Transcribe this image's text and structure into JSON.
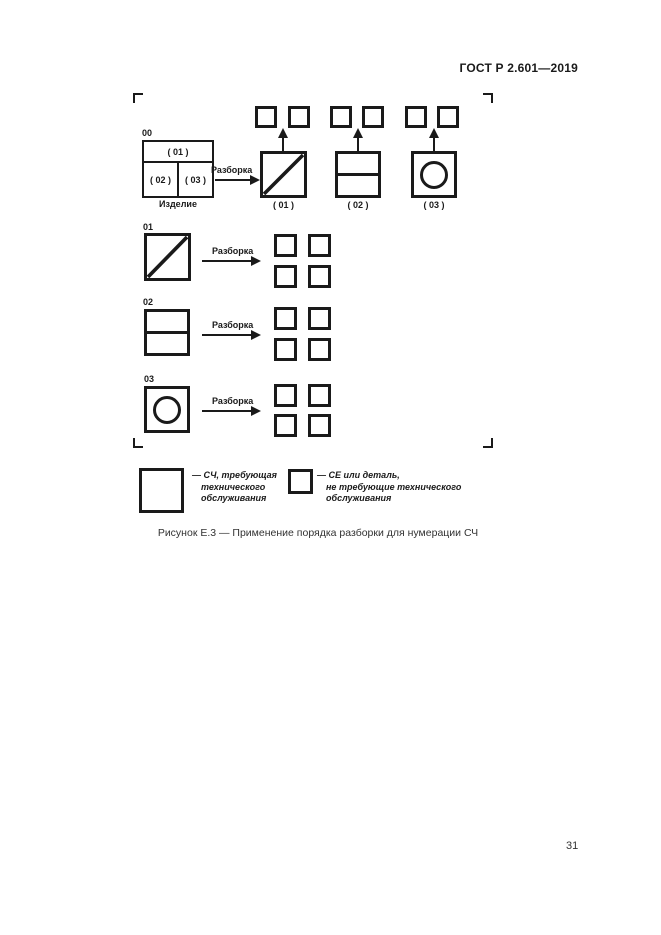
{
  "header": {
    "title": "ГОСТ Р 2.601—2019"
  },
  "footer": {
    "page_number": "31"
  },
  "figure": {
    "caption": "Рисунок Е.3 — Применение порядка разборки для нумерации СЧ",
    "arrow_label": "Разборка",
    "product": {
      "id": "00",
      "cell_top": "( 01 )",
      "cell_left": "( 02 )",
      "cell_right": "( 03 )",
      "caption": "Изделие"
    },
    "level1": [
      {
        "label": "( 01 )"
      },
      {
        "label": "( 02 )"
      },
      {
        "label": "( 03 )"
      }
    ],
    "rows": [
      {
        "id": "01"
      },
      {
        "id": "02"
      },
      {
        "id": "03"
      }
    ],
    "legend": [
      {
        "lines": [
          "— СЧ, требующая",
          "технического",
          "обслуживания"
        ]
      },
      {
        "lines": [
          "— СЕ или деталь,",
          "не требующие технического",
          "обслуживания"
        ]
      }
    ]
  }
}
